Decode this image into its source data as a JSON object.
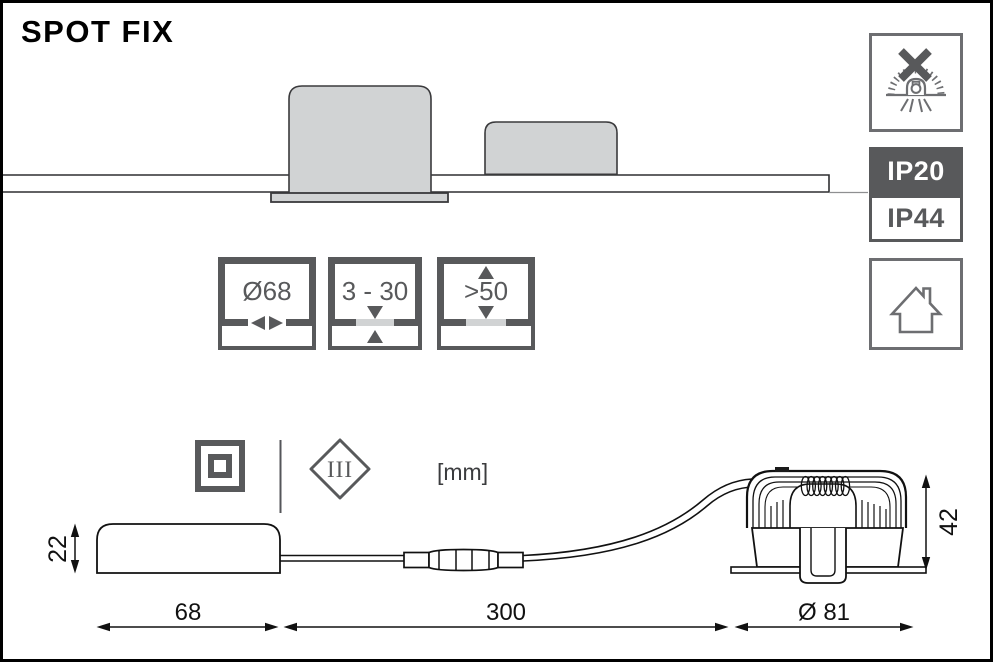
{
  "title": "SPOT FIX",
  "units_label": "[mm]",
  "protection_class_label": "III",
  "ip_ratings": {
    "primary": "IP20",
    "secondary": "IP44"
  },
  "spec_boxes": [
    {
      "label": "Ø68",
      "icon": "cutout-diameter-icon"
    },
    {
      "label": "3 - 30",
      "icon": "ceiling-thickness-icon"
    },
    {
      "label": ">50",
      "icon": "min-clearance-icon"
    }
  ],
  "dimensions": {
    "driver_height": "22",
    "driver_length": "68",
    "cable_length": "300",
    "spot_diameter": "Ø 81",
    "spot_height": "42"
  },
  "icons": {
    "top_right": "no-insulation-cover-icon",
    "bottom_right": "indoor-use-house-icon",
    "class2": "double-square-icon",
    "class3": "diamond-class-III-icon"
  },
  "colors": {
    "icon_gray": "#6D6E71",
    "dark_gray": "#58595B",
    "light_gray_fill": "#D1D3D4",
    "line_black": "#111111"
  }
}
